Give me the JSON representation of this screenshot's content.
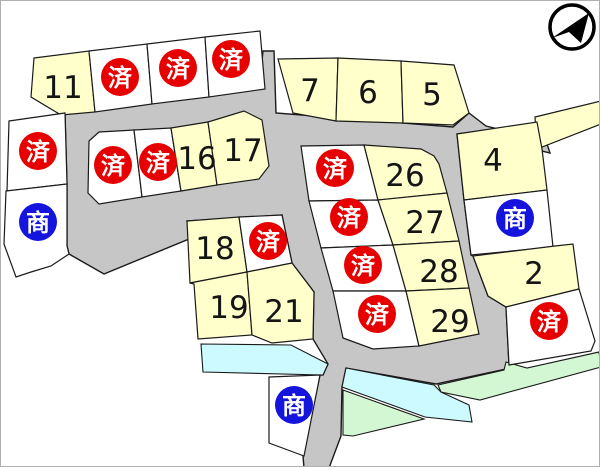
{
  "legend": {
    "sold_label": "済",
    "commercial_label": "商"
  },
  "lots": {
    "l11": {
      "label": "11"
    },
    "l16": {
      "label": "16"
    },
    "l17": {
      "label": "17"
    },
    "l7": {
      "label": "7"
    },
    "l6": {
      "label": "6"
    },
    "l5": {
      "label": "5"
    },
    "l4": {
      "label": "4"
    },
    "l2": {
      "label": "2"
    },
    "l18": {
      "label": "18"
    },
    "l19": {
      "label": "19"
    },
    "l21": {
      "label": "21"
    },
    "l26": {
      "label": "26"
    },
    "l27": {
      "label": "27"
    },
    "l28": {
      "label": "28"
    },
    "l29": {
      "label": "29"
    }
  },
  "counts": {
    "sold_lots": 12,
    "commercial_lots": 3,
    "available_lots": 15
  },
  "colors": {
    "available_lot_fill": "#ffffcc",
    "sold_lot_fill": "#ffffff",
    "road_fill": "#c6c6c6",
    "water_fill": "#ccfaff",
    "green_fill": "#d2f7d2",
    "sold_badge": "#e60000",
    "commercial_badge": "#1414dd",
    "outline": "#1a1a1a"
  }
}
